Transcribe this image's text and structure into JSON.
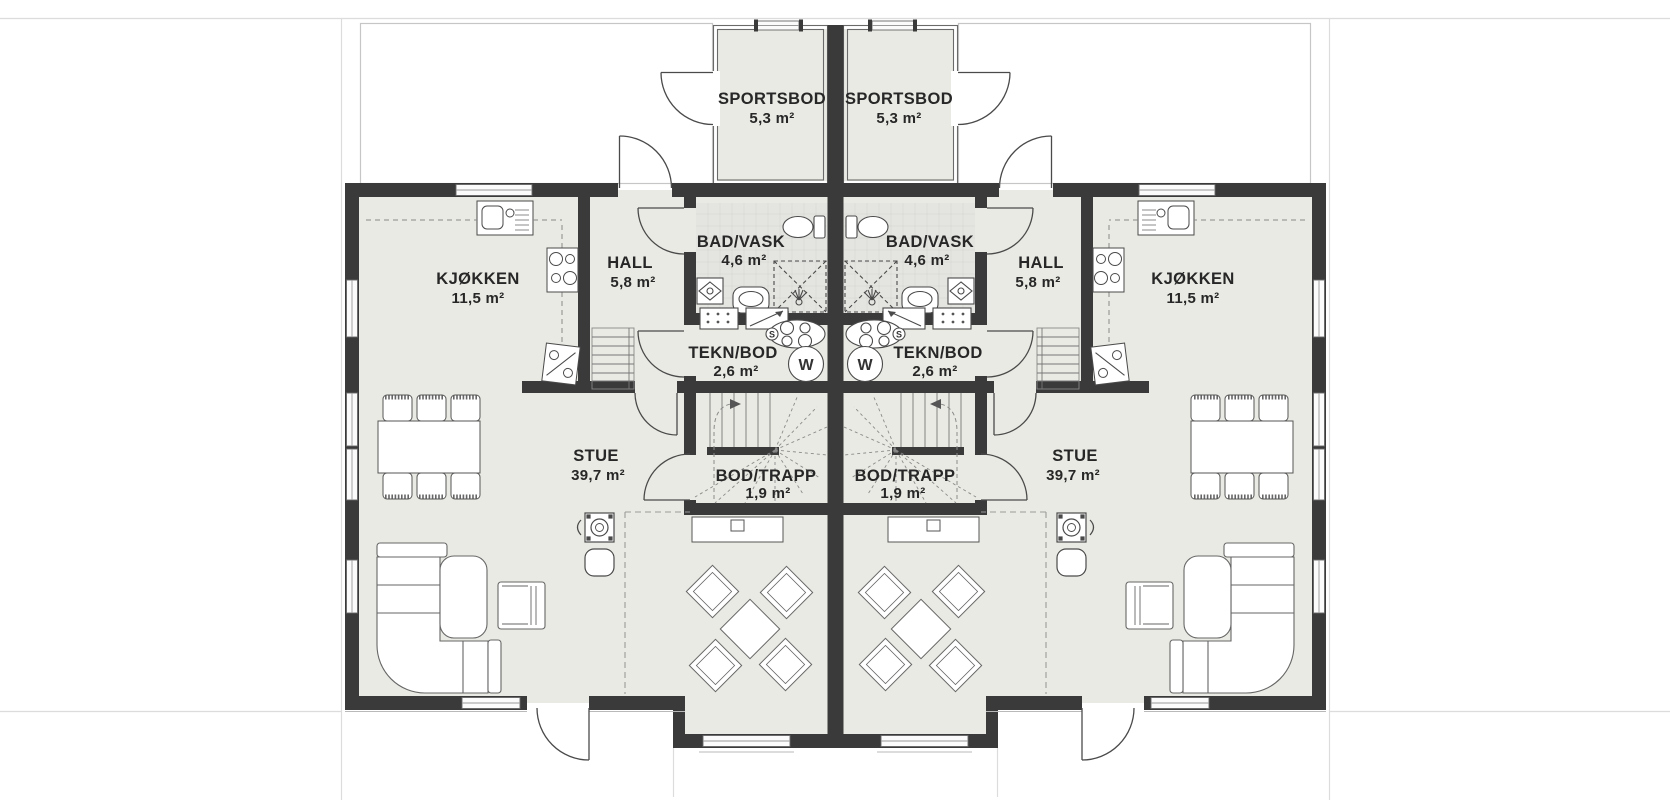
{
  "document": {
    "type": "floor-plan",
    "language": "norwegian",
    "style": "duplex mirrored plan"
  },
  "rooms": {
    "sportsbod": {
      "name": "SPORTSBOD",
      "area": "5,3 m²"
    },
    "bad_vask": {
      "name": "BAD/VASK",
      "area": "4,6 m²"
    },
    "hall": {
      "name": "HALL",
      "area": "5,8 m²"
    },
    "kjokken": {
      "name": "KJØKKEN",
      "area": "11,5 m²"
    },
    "tekn_bod": {
      "name": "TEKN/BOD",
      "area": "2,6 m²"
    },
    "bod_trapp": {
      "name": "BOD/TRAPP",
      "area": "1,9 m²"
    },
    "stue": {
      "name": "STUE",
      "area": "39,7 m²"
    }
  },
  "appliance_symbols": {
    "washing_machine": "W",
    "drain": "S"
  },
  "colors": {
    "wall": "#3a3a3a",
    "floor": "#eaeae4",
    "bath_floor": "#e4e4e0",
    "sportsbod_floor": "#e9e9e3",
    "line": "#4a4a4a",
    "background": "#ffffff"
  }
}
